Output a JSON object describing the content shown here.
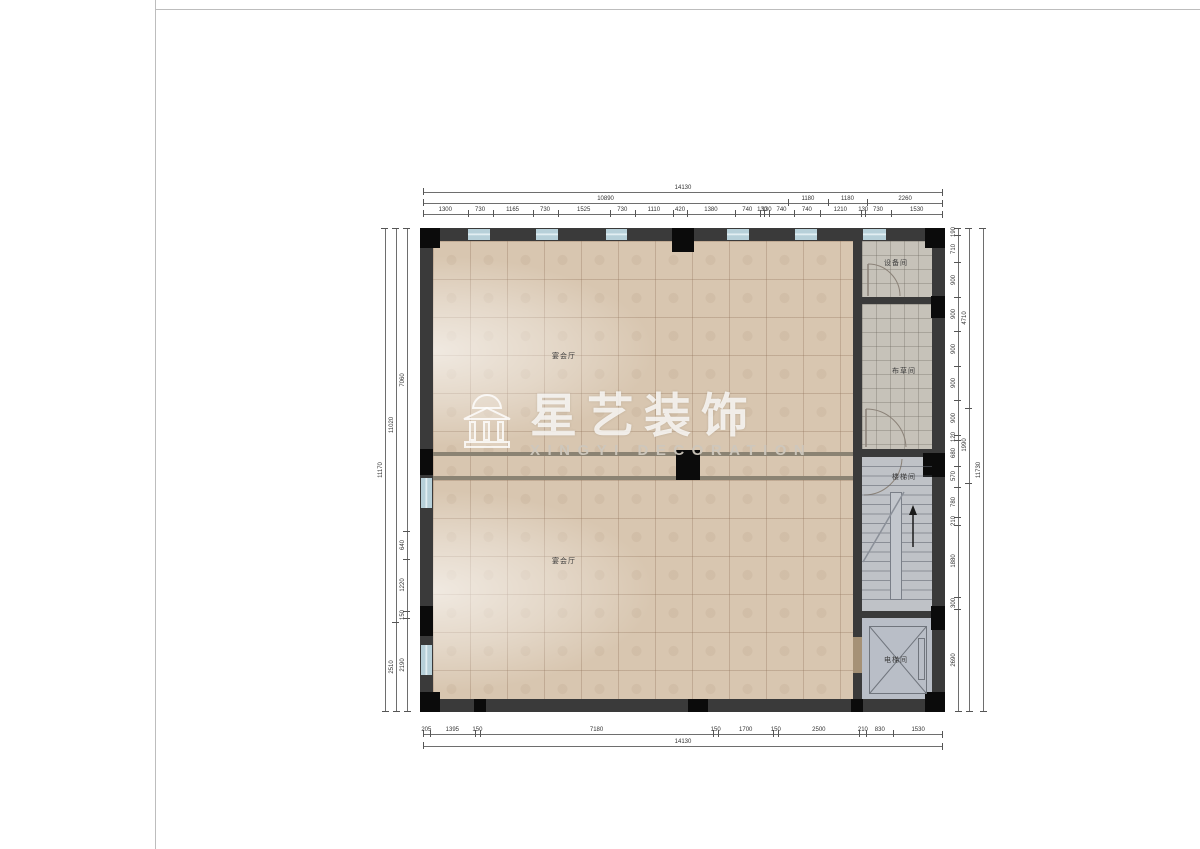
{
  "watermark": {
    "brand": "星艺装饰",
    "subtitle": "XINGYI DECORATION",
    "icon": "pavilion-logo"
  },
  "rooms": {
    "banquet_upper": "宴会厅",
    "banquet_lower": "宴会厅",
    "equipment": "设备间",
    "linen": "布草间",
    "stair": "楼梯间",
    "elevator": "电梯间"
  },
  "colors": {
    "wall": "#3a3a3a",
    "column": "#0b0b0b",
    "window": "#b7d0d9",
    "floor_main": "#d8c6b0",
    "floor_service": "#c6c2b9",
    "floor_stair": "#bfc2c7",
    "floor_elevator": "#b9bec7"
  },
  "dimensions": {
    "top": {
      "total": [
        14130
      ],
      "groups": [
        10890,
        1180,
        1180,
        2260
      ],
      "detail": [
        1300,
        730,
        1165,
        730,
        1525,
        730,
        1110,
        420,
        1380,
        740,
        130,
        130,
        740,
        740,
        1210,
        130,
        730,
        1530
      ]
    },
    "bottom": {
      "detail": [
        205,
        1395,
        150,
        7180,
        150,
        1700,
        150,
        2500,
        210,
        830,
        1530
      ],
      "total": [
        14130
      ]
    },
    "left": {
      "inner": [
        7060,
        640,
        1220,
        150,
        2190
      ],
      "middle": [
        11020,
        2510
      ],
      "outer": [
        11170
      ]
    },
    "right": {
      "inner": [
        190,
        710,
        900,
        900,
        900,
        900,
        900,
        120,
        680,
        570,
        780,
        210,
        1880,
        300,
        2690
      ],
      "middle": [
        4710,
        1990,
        {
          "v": 6000,
          "label": ""
        }
      ],
      "outer": [
        11730
      ]
    }
  }
}
